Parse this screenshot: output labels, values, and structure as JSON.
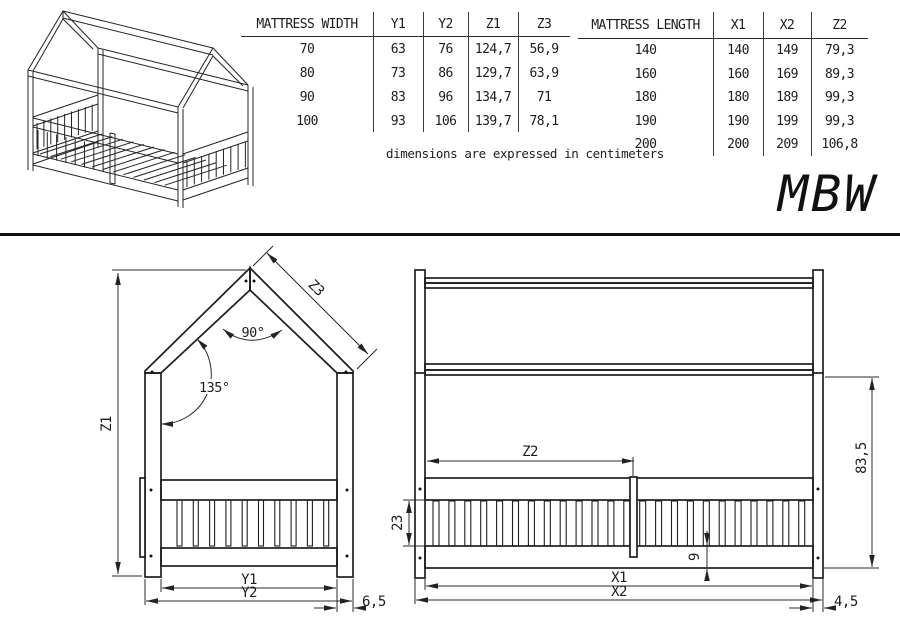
{
  "product_code": "MBW",
  "note": "dimensions are expressed in centimeters",
  "width_table": {
    "headers": [
      "MATTRESS WIDTH",
      "Y1",
      "Y2",
      "Z1",
      "Z3"
    ],
    "rows": [
      [
        "70",
        "63",
        "76",
        "124,7",
        "56,9"
      ],
      [
        "80",
        "73",
        "86",
        "129,7",
        "63,9"
      ],
      [
        "90",
        "83",
        "96",
        "134,7",
        "71"
      ],
      [
        "100",
        "93",
        "106",
        "139,7",
        "78,1"
      ]
    ]
  },
  "length_table": {
    "headers": [
      "MATTRESS LENGTH",
      "X1",
      "X2",
      "Z2"
    ],
    "rows": [
      [
        "140",
        "140",
        "149",
        "79,3"
      ],
      [
        "160",
        "160",
        "169",
        "89,3"
      ],
      [
        "180",
        "180",
        "189",
        "99,3"
      ],
      [
        "190",
        "190",
        "199",
        "99,3"
      ],
      [
        "200",
        "200",
        "209",
        "106,8"
      ]
    ]
  },
  "front_view": {
    "dim_z1": "Z1",
    "dim_z3": "Z3",
    "angle_peak": "90°",
    "angle_eave": "135°",
    "dim_y1": "Y1",
    "dim_y2": "Y2",
    "dim_post": "6,5"
  },
  "side_view": {
    "dim_z2": "Z2",
    "dim_slat_band": "23",
    "dim_bottom_rail": "9",
    "dim_x1": "X1",
    "dim_x2": "X2",
    "dim_post": "4,5",
    "dim_wall_height": "83,5"
  }
}
